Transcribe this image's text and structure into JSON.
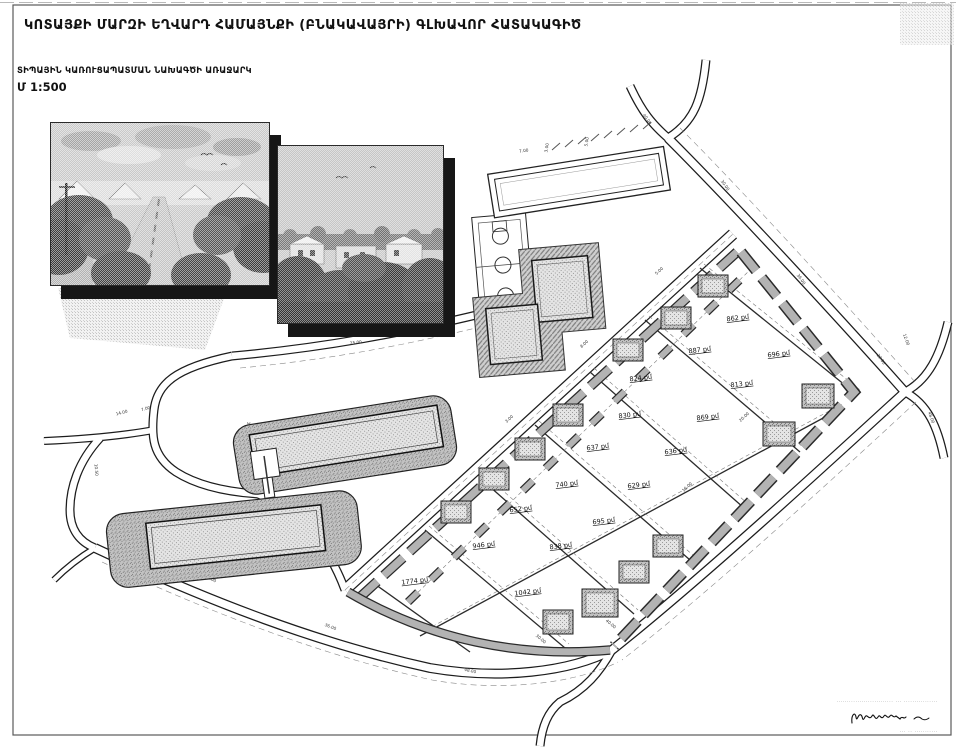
{
  "sheet": {
    "title": "ԿՈՏԱՅՔԻ ՄԱՐԶԻ ԵՂՎԱՐԴ ՀԱՄԱՅՆՔԻ (ԲՆԱԿԱՎԱՅՐԻ) ԳԼԽԱՎՈՐ ՀԱՏԱԿԱԳԻԾ",
    "subtitle": "ՏԻՊԱՅԻՆ ԿԱՌՈՒՑԱՊԱՏՄԱՆ ՆԱԽԱԳԾԻ ԱՌԱՋԱՐԿ",
    "scale_label": "Մ 1:500"
  },
  "plan": {
    "unit": "քմ",
    "colors": {
      "paper": "#ffffff",
      "line": "#1c1c1c",
      "sidewalk": "#b3b3b3",
      "stipple_light": "#e2e2e2",
      "stipple_mid": "#bdbdbd"
    },
    "parcels": [
      {
        "label": "862 քմ",
        "x": 738,
        "y": 320
      },
      {
        "label": "887 քմ",
        "x": 700,
        "y": 352
      },
      {
        "label": "696 քմ",
        "x": 779,
        "y": 356
      },
      {
        "label": "824 քմ",
        "x": 641,
        "y": 380
      },
      {
        "label": "813 քմ",
        "x": 742,
        "y": 386
      },
      {
        "label": "830 քմ",
        "x": 630,
        "y": 417
      },
      {
        "label": "869 քմ",
        "x": 708,
        "y": 419
      },
      {
        "label": "637 քմ",
        "x": 598,
        "y": 449
      },
      {
        "label": "636 քմ",
        "x": 676,
        "y": 453
      },
      {
        "label": "740 քմ",
        "x": 567,
        "y": 486
      },
      {
        "label": "629 քմ",
        "x": 639,
        "y": 487
      },
      {
        "label": "652 քմ",
        "x": 521,
        "y": 511
      },
      {
        "label": "695 քմ",
        "x": 604,
        "y": 523
      },
      {
        "label": "946 քմ",
        "x": 484,
        "y": 547
      },
      {
        "label": "838 քմ",
        "x": 561,
        "y": 548
      },
      {
        "label": "1774 քմ",
        "x": 415,
        "y": 583
      },
      {
        "label": "1042 քմ",
        "x": 528,
        "y": 594
      }
    ],
    "houses": [
      {
        "x": 713,
        "y": 286,
        "w": 30,
        "h": 22
      },
      {
        "x": 676,
        "y": 318,
        "w": 30,
        "h": 22
      },
      {
        "x": 628,
        "y": 350,
        "w": 30,
        "h": 22
      },
      {
        "x": 568,
        "y": 415,
        "w": 30,
        "h": 22
      },
      {
        "x": 530,
        "y": 449,
        "w": 30,
        "h": 22
      },
      {
        "x": 494,
        "y": 479,
        "w": 30,
        "h": 22
      },
      {
        "x": 456,
        "y": 512,
        "w": 30,
        "h": 22
      },
      {
        "x": 818,
        "y": 396,
        "w": 32,
        "h": 24
      },
      {
        "x": 779,
        "y": 434,
        "w": 32,
        "h": 24
      },
      {
        "x": 668,
        "y": 546,
        "w": 30,
        "h": 22
      },
      {
        "x": 634,
        "y": 572,
        "w": 30,
        "h": 22
      },
      {
        "x": 600,
        "y": 603,
        "w": 36,
        "h": 28
      },
      {
        "x": 558,
        "y": 622,
        "w": 30,
        "h": 24
      }
    ],
    "dimension_labels": [
      {
        "t": "25.00",
        "x": 356,
        "y": 344,
        "r": -7
      },
      {
        "t": "7.00",
        "x": 420,
        "y": 334,
        "r": -7
      },
      {
        "t": "54.50",
        "x": 560,
        "y": 196,
        "r": -9
      },
      {
        "t": "7.00",
        "x": 524,
        "y": 152,
        "r": -9
      },
      {
        "t": "3.00",
        "x": 548,
        "y": 148,
        "r": -80
      },
      {
        "t": "5.00",
        "x": 588,
        "y": 142,
        "r": -80
      },
      {
        "t": "25.00",
        "x": 486,
        "y": 236,
        "r": -9
      },
      {
        "t": "40.00",
        "x": 646,
        "y": 120,
        "r": 55
      },
      {
        "t": "30.00",
        "x": 724,
        "y": 186,
        "r": 55
      },
      {
        "t": "36.00",
        "x": 800,
        "y": 280,
        "r": 55
      },
      {
        "t": "22.00",
        "x": 880,
        "y": 360,
        "r": 55
      },
      {
        "t": "48.00",
        "x": 930,
        "y": 418,
        "r": 70
      },
      {
        "t": "12.00",
        "x": 905,
        "y": 340,
        "r": 70
      },
      {
        "t": "6.00",
        "x": 286,
        "y": 505,
        "r": 25
      },
      {
        "t": "14.00",
        "x": 122,
        "y": 414,
        "r": -15
      },
      {
        "t": "7.00",
        "x": 146,
        "y": 410,
        "r": -15
      },
      {
        "t": "10.50",
        "x": 95,
        "y": 470,
        "r": 85
      },
      {
        "t": "18.00",
        "x": 210,
        "y": 580,
        "r": 25
      },
      {
        "t": "36.00",
        "x": 330,
        "y": 628,
        "r": 22
      },
      {
        "t": "48.00",
        "x": 470,
        "y": 672,
        "r": 12
      },
      {
        "t": "40.00",
        "x": 610,
        "y": 625,
        "r": 40
      },
      {
        "t": "3.00",
        "x": 510,
        "y": 420,
        "r": -43
      },
      {
        "t": "8.00",
        "x": 585,
        "y": 345,
        "r": -43
      },
      {
        "t": "5.00",
        "x": 660,
        "y": 272,
        "r": -43
      },
      {
        "t": "20.00",
        "x": 745,
        "y": 418,
        "r": -43
      },
      {
        "t": "16.00",
        "x": 688,
        "y": 488,
        "r": -43
      },
      {
        "t": "30.00",
        "x": 540,
        "y": 640,
        "r": 40
      },
      {
        "t": "25.00",
        "x": 248,
        "y": 428,
        "r": 80
      }
    ]
  },
  "footer": {
    "micro_line_1": "··························· ··· ················",
    "micro_line_2": "··· ·· ···········"
  }
}
